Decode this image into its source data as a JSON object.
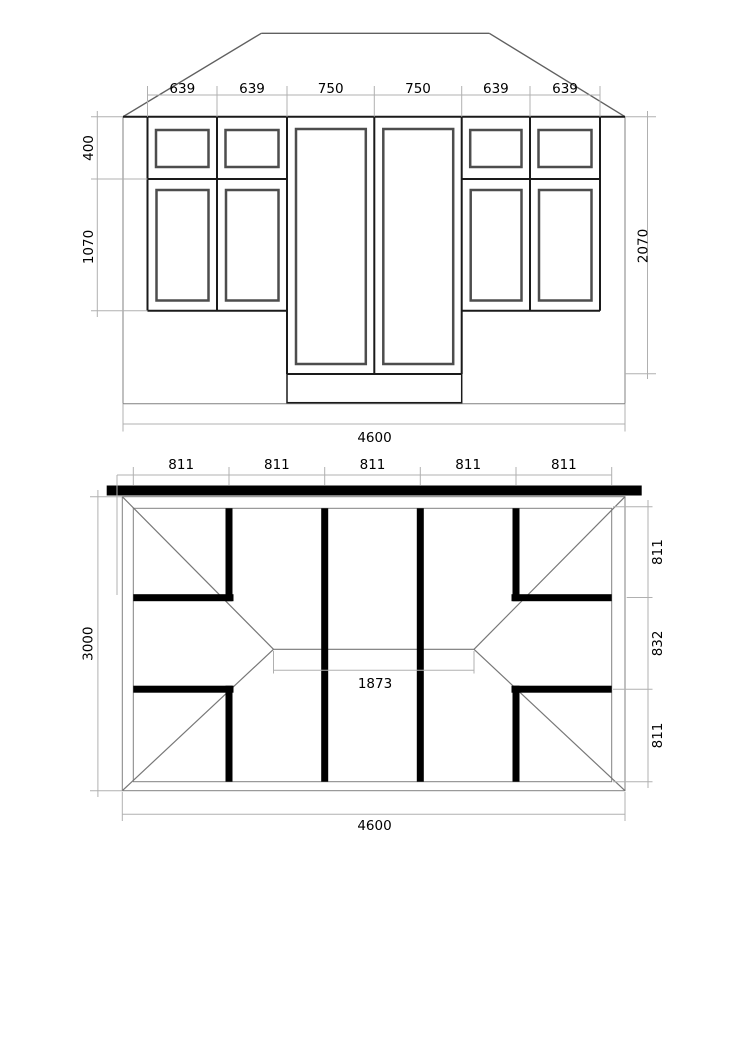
{
  "drawing": {
    "type": "architectural dimension drawing",
    "views": [
      "front elevation",
      "roof plan"
    ]
  },
  "elevation": {
    "top_dims": [
      "639",
      "639",
      "750",
      "750",
      "639",
      "639"
    ],
    "left_dims": [
      "400",
      "1070"
    ],
    "right_dim": "2070",
    "bottom_dim": "4600"
  },
  "plan": {
    "top_dims": [
      "811",
      "811",
      "811",
      "811",
      "811"
    ],
    "left_dim": "3000",
    "right_dims": [
      "811",
      "832",
      "811"
    ],
    "ridge_dim": "1873",
    "bottom_dim": "4600"
  },
  "colors": {
    "background": "#ffffff",
    "beam_black": "#000000",
    "frame_dark": "#1a1a1a",
    "sash_gray": "#4d4d4d",
    "outline_gray": "#808080",
    "dim_line_gray": "#b0b0b0",
    "text": "#000000"
  }
}
